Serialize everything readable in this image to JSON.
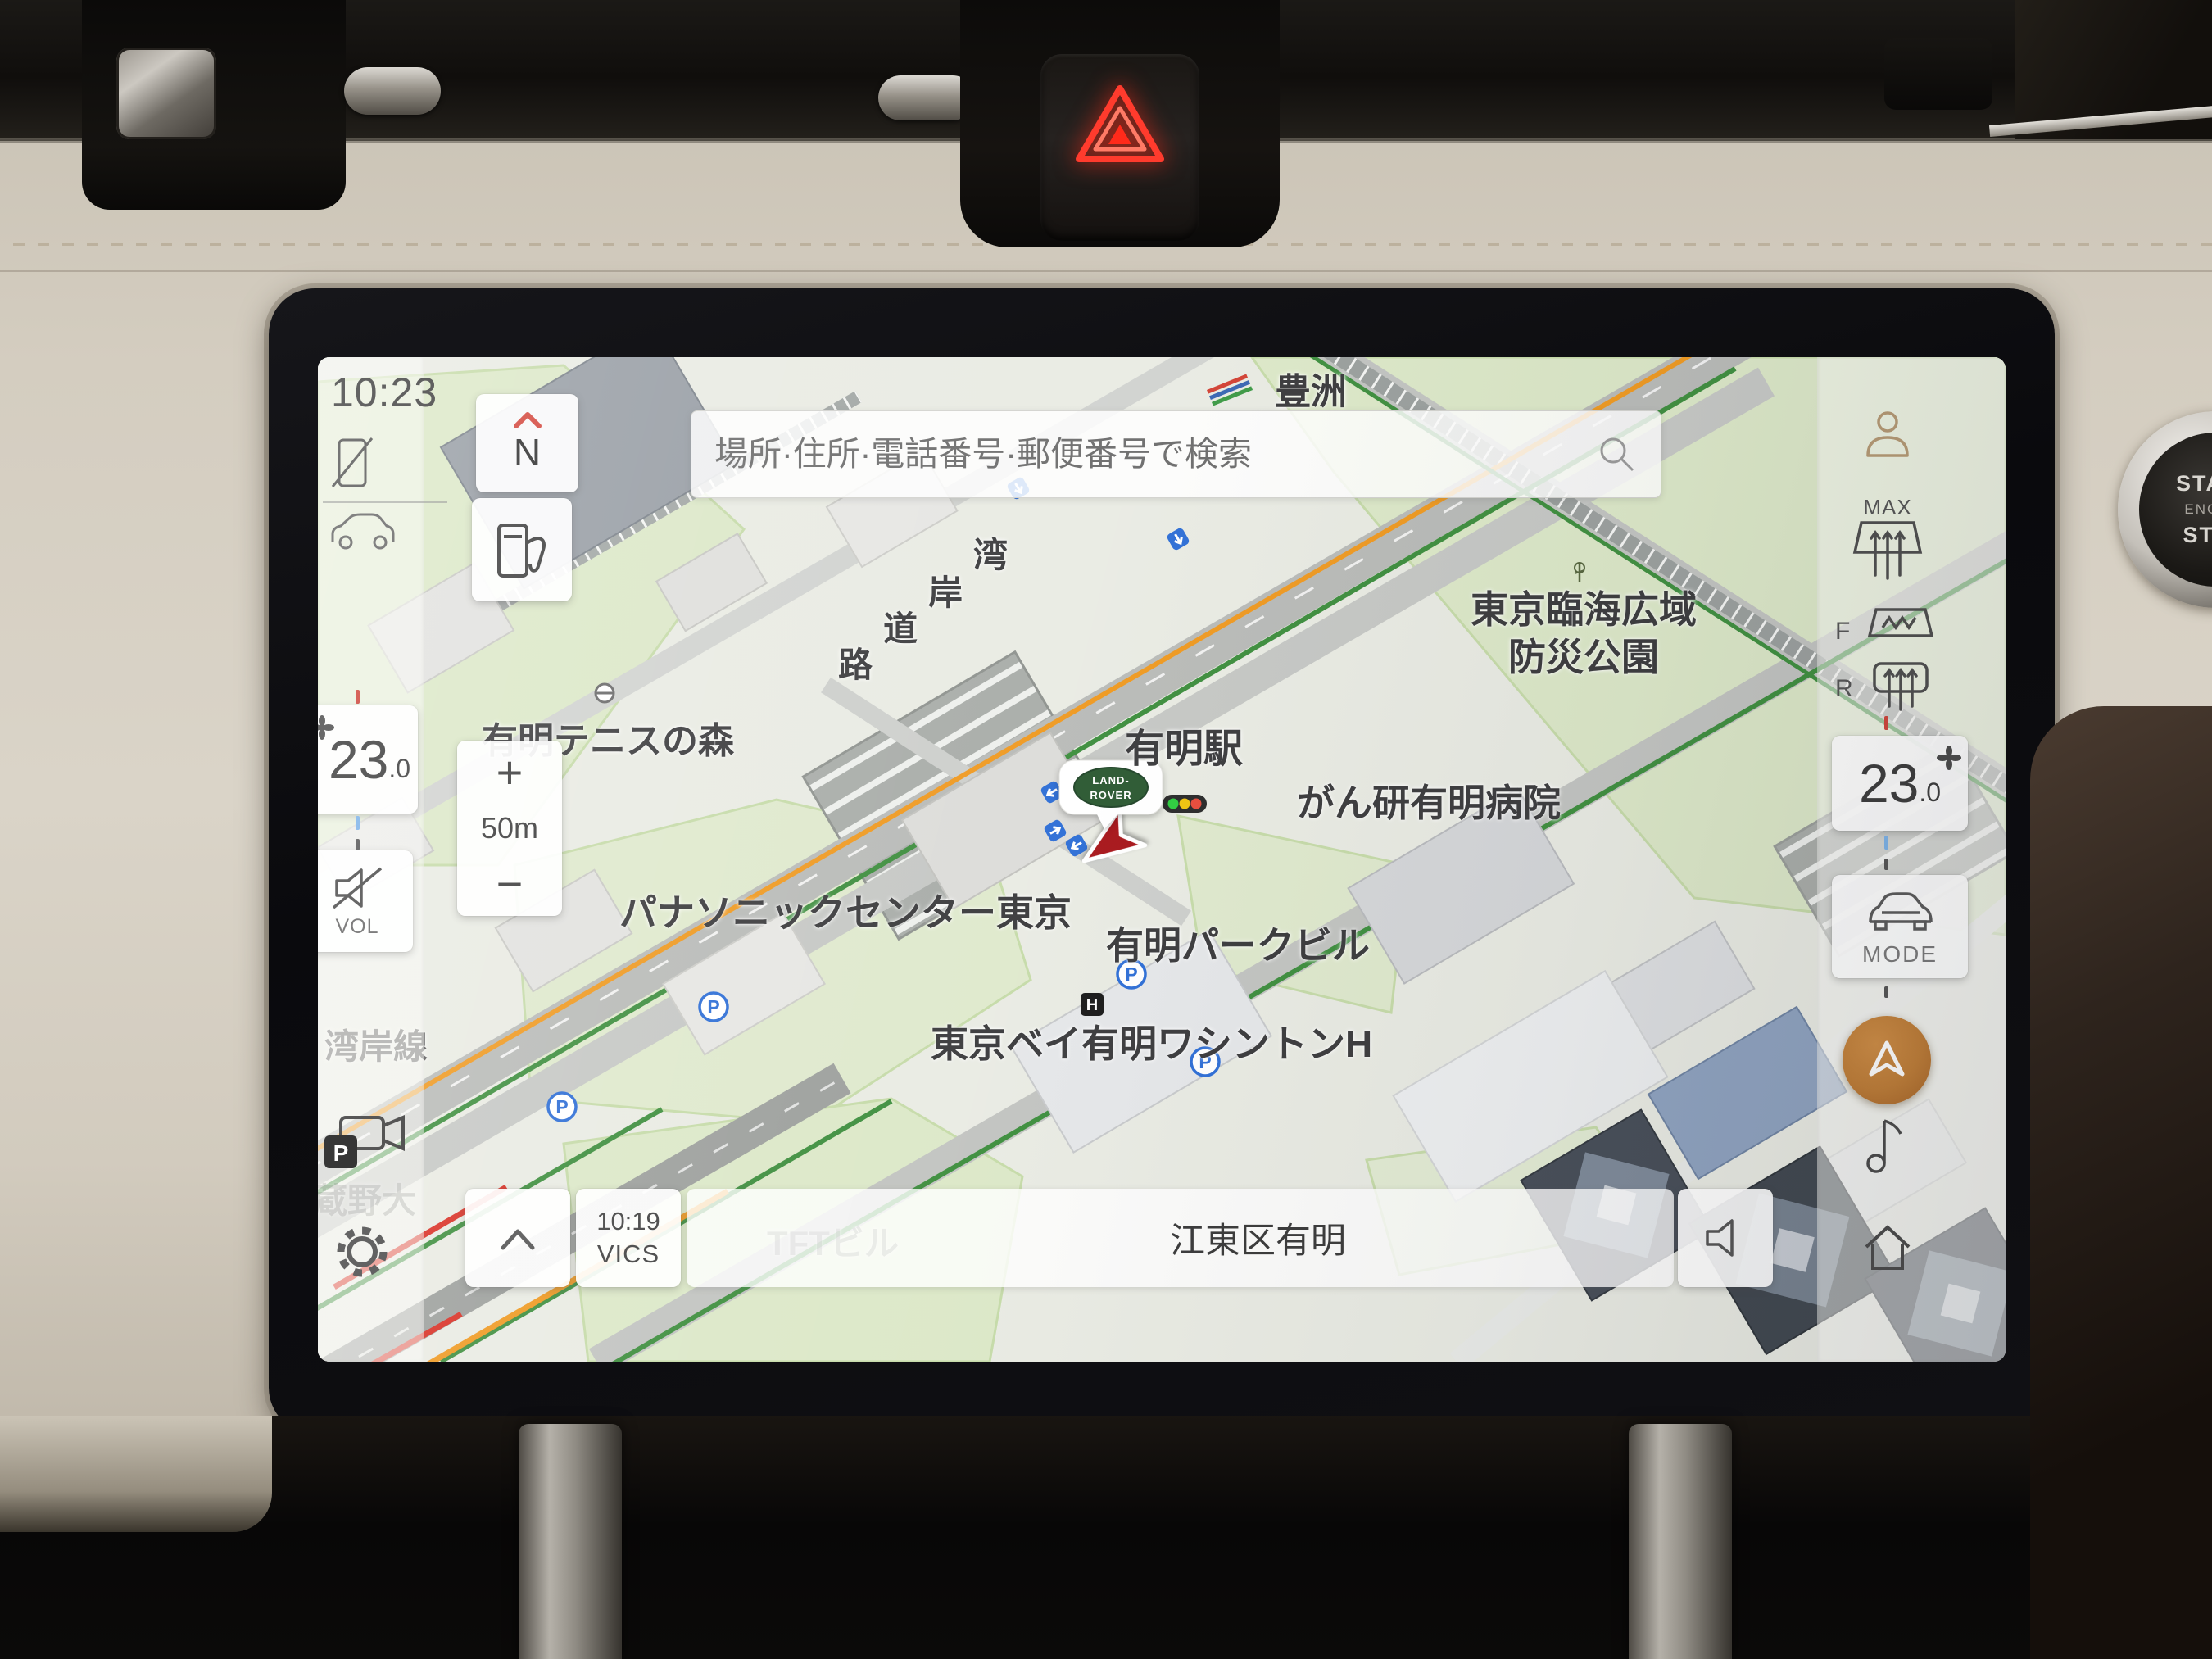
{
  "screen": {
    "clock": "10:23",
    "search_placeholder": "場所·住所·電話番号·郵便番号で検索",
    "compass_n": "N",
    "zoom_in": "+",
    "zoom_scale": "50m",
    "zoom_out": "−",
    "temp_left_int": "23",
    "temp_left_dec": ".0",
    "vol_label": "VOL",
    "temp_right_int": "23",
    "temp_right_dec": ".0",
    "defrost_max": "MAX",
    "defrost_front": "F",
    "defrost_rear": "R",
    "mode_label": "MODE",
    "vics_time": "10:19",
    "vics_label": "VICS",
    "location_bar": "江東区有明",
    "parking_p": "P",
    "hotel_h": "H",
    "camera_p": "P",
    "vehicle_logo_top": "LAND-",
    "vehicle_logo_bottom": "ROVER",
    "map_labels": [
      {
        "text": "豊洲"
      },
      {
        "text": "東京臨海広域"
      },
      {
        "text": "防災公園"
      },
      {
        "text": "有明駅"
      },
      {
        "text": "がん研有明病院"
      },
      {
        "text": "有明テニスの森"
      },
      {
        "text": "パナソニックセンター東京"
      },
      {
        "text": "有明パークビル"
      },
      {
        "text": "東京ベイ有明ワシントンH"
      },
      {
        "text": "湾岸線"
      },
      {
        "text": "TFTビル"
      },
      {
        "text": "蔵野大"
      },
      {
        "text": "湾"
      },
      {
        "text": "岸"
      },
      {
        "text": "道"
      },
      {
        "text": "路"
      }
    ]
  },
  "dashboard": {
    "engine_start": "START",
    "engine_engine": "ENGINE",
    "engine_stop": "STOP"
  },
  "colors": {
    "nav_button_orange": "#bf7d36",
    "hazard_red": "#ff2a1a",
    "traffic_orange": "#ef9a22",
    "route_green": "#3f8f3f",
    "alert_red": "#d93025",
    "land_rover_green": "#2d5a33"
  }
}
